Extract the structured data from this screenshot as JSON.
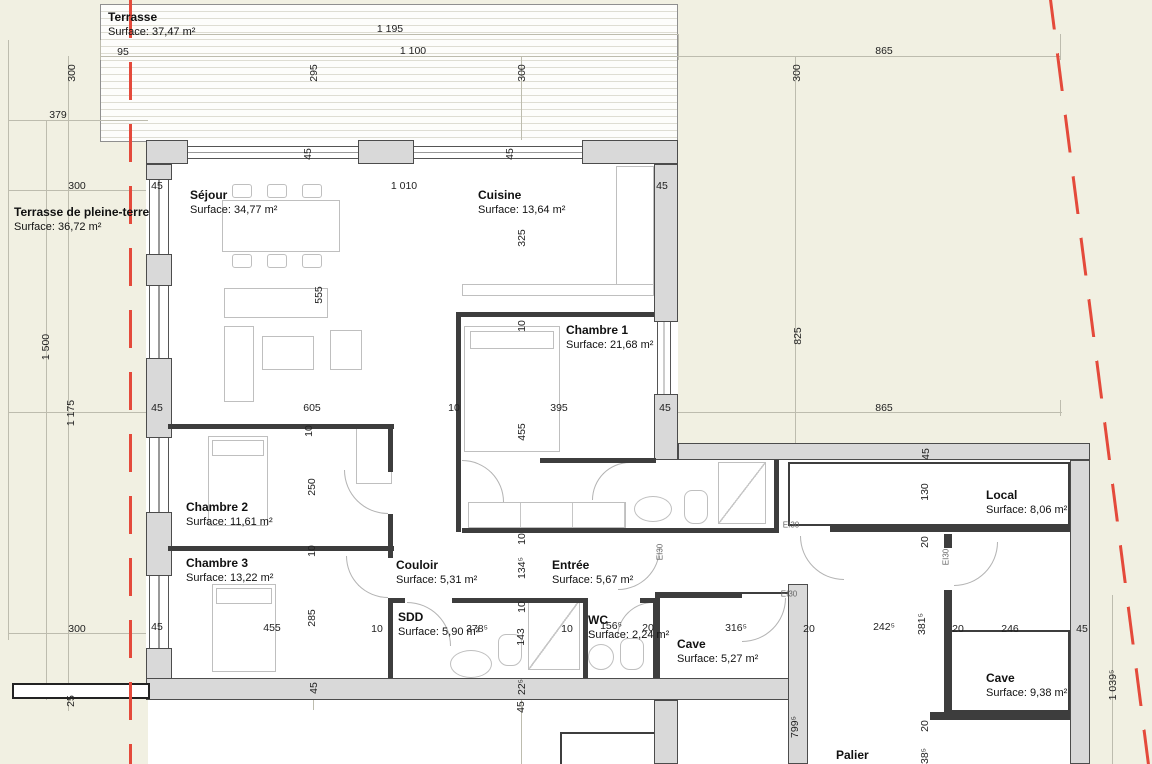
{
  "plan_title": "Floor plan",
  "rooms": [
    {
      "name": "Terrasse",
      "surface": "Surface: 37,47 m²",
      "x": 108,
      "y": 10
    },
    {
      "name": "Terrasse de pleine-terre",
      "surface": "Surface: 36,72 m²",
      "x": 14,
      "y": 205
    },
    {
      "name": "Séjour",
      "surface": "Surface: 34,77 m²",
      "x": 190,
      "y": 188
    },
    {
      "name": "Cuisine",
      "surface": "Surface: 13,64 m²",
      "x": 478,
      "y": 188
    },
    {
      "name": "Chambre 1",
      "surface": "Surface: 21,68 m²",
      "x": 566,
      "y": 323
    },
    {
      "name": "Chambre 2",
      "surface": "Surface: 11,61 m²",
      "x": 186,
      "y": 500
    },
    {
      "name": "Chambre 3",
      "surface": "Surface: 13,22 m²",
      "x": 186,
      "y": 556
    },
    {
      "name": "Couloir",
      "surface": "Surface: 5,31 m²",
      "x": 396,
      "y": 558
    },
    {
      "name": "Entrée",
      "surface": "Surface: 5,67 m²",
      "x": 552,
      "y": 558
    },
    {
      "name": "SDD",
      "surface": "Surface: 5,90 m²",
      "x": 398,
      "y": 610
    },
    {
      "name": "WC",
      "surface": "Surface: 2,24 m²",
      "x": 588,
      "y": 613
    },
    {
      "name": "Cave",
      "surface": "Surface: 5,27 m²",
      "x": 677,
      "y": 637
    },
    {
      "name": "Local",
      "surface": "Surface: 8,06 m²",
      "x": 986,
      "y": 488
    },
    {
      "name": "Cave",
      "surface": "Surface: 9,38 m²",
      "x": 986,
      "y": 671
    },
    {
      "name": "Palier",
      "surface": "",
      "x": 836,
      "y": 748
    }
  ],
  "dimensions": [
    {
      "t": "1 195",
      "x": 390,
      "y": 29,
      "v": false
    },
    {
      "t": "1 100",
      "x": 413,
      "y": 51,
      "v": false
    },
    {
      "t": "95",
      "x": 123,
      "y": 52,
      "v": false
    },
    {
      "t": "295",
      "x": 314,
      "y": 73,
      "v": true
    },
    {
      "t": "300",
      "x": 522,
      "y": 73,
      "v": true
    },
    {
      "t": "865",
      "x": 884,
      "y": 51,
      "v": false
    },
    {
      "t": "300",
      "x": 797,
      "y": 73,
      "v": true
    },
    {
      "t": "300",
      "x": 72,
      "y": 73,
      "v": true
    },
    {
      "t": "379",
      "x": 58,
      "y": 115,
      "v": false
    },
    {
      "t": "300",
      "x": 77,
      "y": 186,
      "v": false
    },
    {
      "t": "45",
      "x": 157,
      "y": 186,
      "v": false
    },
    {
      "t": "1 010",
      "x": 404,
      "y": 186,
      "v": false
    },
    {
      "t": "45",
      "x": 308,
      "y": 154,
      "v": true
    },
    {
      "t": "45",
      "x": 510,
      "y": 154,
      "v": true
    },
    {
      "t": "45",
      "x": 662,
      "y": 186,
      "v": false
    },
    {
      "t": "325",
      "x": 522,
      "y": 238,
      "v": true
    },
    {
      "t": "555",
      "x": 319,
      "y": 295,
      "v": true
    },
    {
      "t": "10",
      "x": 522,
      "y": 326,
      "v": true
    },
    {
      "t": "825",
      "x": 798,
      "y": 336,
      "v": true
    },
    {
      "t": "1 500",
      "x": 46,
      "y": 347,
      "v": true
    },
    {
      "t": "1 175",
      "x": 71,
      "y": 413,
      "v": true
    },
    {
      "t": "45",
      "x": 157,
      "y": 408,
      "v": false
    },
    {
      "t": "605",
      "x": 312,
      "y": 408,
      "v": false
    },
    {
      "t": "10",
      "x": 454,
      "y": 408,
      "v": false
    },
    {
      "t": "395",
      "x": 559,
      "y": 408,
      "v": false
    },
    {
      "t": "45",
      "x": 665,
      "y": 408,
      "v": false
    },
    {
      "t": "865",
      "x": 884,
      "y": 408,
      "v": false
    },
    {
      "t": "455",
      "x": 522,
      "y": 432,
      "v": true
    },
    {
      "t": "45",
      "x": 926,
      "y": 454,
      "v": true
    },
    {
      "t": "130",
      "x": 925,
      "y": 492,
      "v": true
    },
    {
      "t": "20",
      "x": 925,
      "y": 542,
      "v": true
    },
    {
      "t": "10",
      "x": 309,
      "y": 431,
      "v": true
    },
    {
      "t": "250",
      "x": 312,
      "y": 487,
      "v": true
    },
    {
      "t": "10",
      "x": 312,
      "y": 551,
      "v": true
    },
    {
      "t": "285",
      "x": 312,
      "y": 618,
      "v": true
    },
    {
      "t": "10",
      "x": 522,
      "y": 539,
      "v": true
    },
    {
      "t": "134⁵",
      "x": 522,
      "y": 568,
      "v": true
    },
    {
      "t": "10",
      "x": 522,
      "y": 607,
      "v": true
    },
    {
      "t": "143",
      "x": 521,
      "y": 637,
      "v": true
    },
    {
      "t": "300",
      "x": 77,
      "y": 629,
      "v": false
    },
    {
      "t": "45",
      "x": 157,
      "y": 627,
      "v": false
    },
    {
      "t": "455",
      "x": 272,
      "y": 628,
      "v": false
    },
    {
      "t": "10",
      "x": 377,
      "y": 629,
      "v": false
    },
    {
      "t": "378⁵",
      "x": 477,
      "y": 629,
      "v": false
    },
    {
      "t": "10",
      "x": 567,
      "y": 629,
      "v": false
    },
    {
      "t": "156⁵",
      "x": 611,
      "y": 626,
      "v": false
    },
    {
      "t": "20",
      "x": 648,
      "y": 628,
      "v": false
    },
    {
      "t": "316⁵",
      "x": 736,
      "y": 628,
      "v": false
    },
    {
      "t": "20",
      "x": 809,
      "y": 629,
      "v": false
    },
    {
      "t": "242⁵",
      "x": 884,
      "y": 627,
      "v": false
    },
    {
      "t": "381⁵",
      "x": 922,
      "y": 624,
      "v": true
    },
    {
      "t": "20",
      "x": 958,
      "y": 629,
      "v": false
    },
    {
      "t": "246",
      "x": 1010,
      "y": 629,
      "v": false
    },
    {
      "t": "45",
      "x": 1082,
      "y": 629,
      "v": false
    },
    {
      "t": "25",
      "x": 71,
      "y": 701,
      "v": true
    },
    {
      "t": "45",
      "x": 314,
      "y": 688,
      "v": true
    },
    {
      "t": "22⁵",
      "x": 522,
      "y": 687,
      "v": true
    },
    {
      "t": "45",
      "x": 521,
      "y": 707,
      "v": true
    },
    {
      "t": "799⁵",
      "x": 795,
      "y": 727,
      "v": true
    },
    {
      "t": "20",
      "x": 925,
      "y": 726,
      "v": true
    },
    {
      "t": "38⁵",
      "x": 925,
      "y": 756,
      "v": true
    },
    {
      "t": "1 039⁵",
      "x": 1113,
      "y": 685,
      "v": true
    }
  ],
  "fire_labels": [
    {
      "t": "EI30",
      "x": 660,
      "y": 552,
      "v": true
    },
    {
      "t": "EI30",
      "x": 791,
      "y": 525,
      "v": false
    },
    {
      "t": "EI30",
      "x": 789,
      "y": 594,
      "v": false
    },
    {
      "t": "EI30",
      "x": 946,
      "y": 557,
      "v": true
    }
  ],
  "colors": {
    "terrain": "#f1f0e2",
    "wall_fill": "#d9d9d9",
    "wall_line": "#4c4c4c",
    "boundary_red": "#e44a3b",
    "dim_line": "#bdbcae"
  }
}
